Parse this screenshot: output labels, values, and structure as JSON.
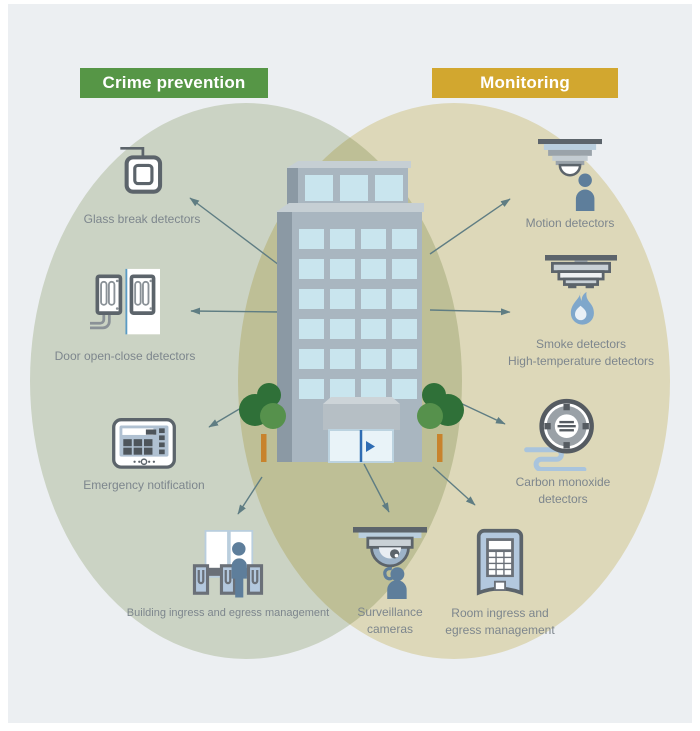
{
  "categories": {
    "crime_prevention": {
      "label": "Crime prevention",
      "color": "#569646"
    },
    "monitoring": {
      "label": "Monitoring",
      "color": "#d2a72f"
    }
  },
  "items": {
    "glass_break": {
      "label": "Glass break detectors",
      "zone": "crime_prevention"
    },
    "door_open_close": {
      "label": "Door open-close detectors",
      "zone": "crime_prevention"
    },
    "emergency_notification": {
      "label": "Emergency notification",
      "zone": "crime_prevention"
    },
    "building_ingress": {
      "label": "Building ingress and egress management",
      "zone": "crime_prevention"
    },
    "surveillance_cameras": {
      "line1": "Surveillance",
      "line2": "cameras",
      "zone": "crime_prevention + monitoring"
    },
    "motion": {
      "label": "Motion detectors",
      "zone": "monitoring"
    },
    "smoke": {
      "line1": "Smoke detectors",
      "line2": "High-temperature detectors",
      "zone": "monitoring"
    },
    "carbon_monoxide": {
      "line1": "Carbon monoxide",
      "line2": "detectors",
      "zone": "monitoring"
    },
    "room_ingress": {
      "line1": "Room ingress and",
      "line2": "egress management",
      "zone": "crime_prevention + monitoring"
    }
  },
  "colors": {
    "background": "#eceff2",
    "frame": "#ffffff",
    "zone_crime_prevention": "#ccd5c5",
    "zone_monitoring": "#ded6b7",
    "zone_overlap": "#c4c7a7",
    "arrow": "#5f7d83",
    "label_text": "#7d868d",
    "icon_outline": "#5c646b",
    "icon_person_blue": "#5e7e9b",
    "icon_light_blue": "#b9cede",
    "building_front": "#a9b6c0",
    "building_side": "#8b99a4",
    "window": "#c9e5ee",
    "tree_dark": "#2f7038",
    "tree_light": "#56914c",
    "tree_trunk": "#c8832c"
  }
}
